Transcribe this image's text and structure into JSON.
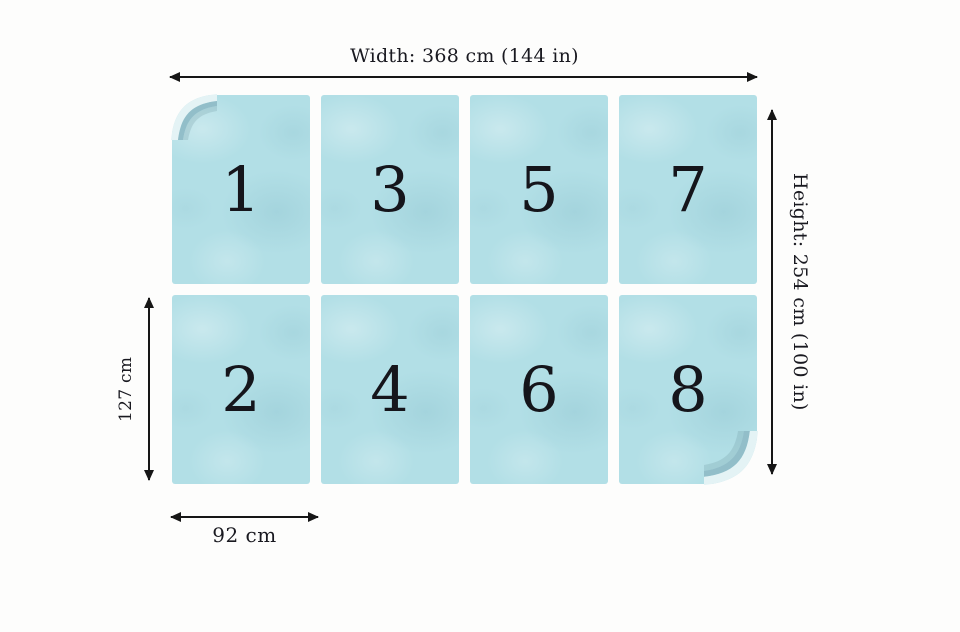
{
  "colors": {
    "panel_blue": "#b2dfe6",
    "ink_black": "#161616",
    "background": "#fdfdfc",
    "curl_highlight": "#e4f3f5",
    "curl_shadow": "#92bec9"
  },
  "diagram": {
    "width_label": "Width: 368 cm (144 in)",
    "height_label": "Height: 254 cm (100 in)",
    "panel_height_label": "127 cm",
    "panel_width_label": "92 cm",
    "grid": {
      "rows": 2,
      "columns": 4
    },
    "panels": [
      {
        "number": "1"
      },
      {
        "number": "3"
      },
      {
        "number": "5"
      },
      {
        "number": "7"
      },
      {
        "number": "2"
      },
      {
        "number": "4"
      },
      {
        "number": "6"
      },
      {
        "number": "8"
      }
    ]
  }
}
